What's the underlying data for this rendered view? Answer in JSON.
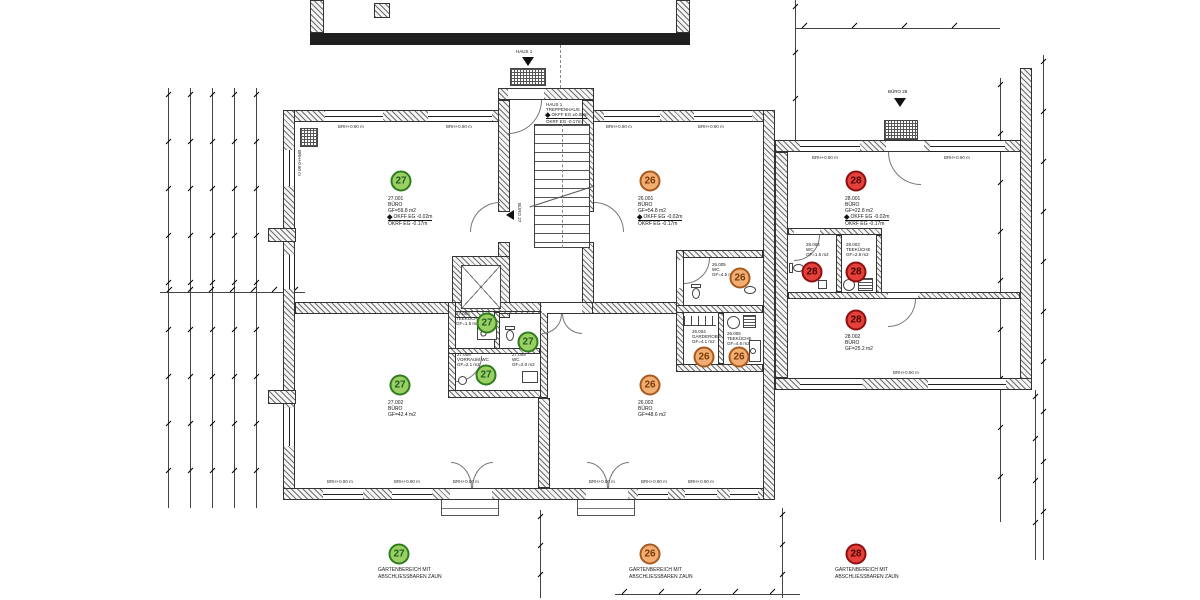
{
  "drawing": {
    "type": "Grundriss Erdgeschoss Bürogebäude"
  },
  "units": {
    "u27": {
      "number": "27",
      "fill": "#9ccf63",
      "ring": "#2e7d1c",
      "text_color": "#1b5e20"
    },
    "u26": {
      "number": "26",
      "fill": "#f2ad72",
      "ring": "#a85a1e",
      "text_color": "#7a3b08"
    },
    "u28": {
      "number": "28",
      "fill": "#e5413a",
      "ring": "#8c1010",
      "text_color": "#4a0000"
    }
  },
  "rooms": {
    "r27_001": {
      "id": "27.001",
      "name": "BÜRO",
      "area": "GF=59.8 m2",
      "okff": "OKFF EG -0.02m",
      "okrf": "OKRF EG -0.17m"
    },
    "r27_002": {
      "id": "27.002",
      "name": "BÜRO",
      "area": "GF=42.4 m2"
    },
    "r27_003": {
      "id": "27.003",
      "name": "TEEKÜCHE",
      "area": "GF=1.5 m2"
    },
    "r27_005": {
      "id": "27.005",
      "name": "WC",
      "area": "GF=2.0 m2"
    },
    "r27_006": {
      "id": "27.006",
      "name": "VORRAUM WC",
      "area": "GF=2.1 m2"
    },
    "r26_001": {
      "id": "26.001",
      "name": "BÜRO",
      "area": "GF=54.8 m2",
      "okff": "OKFF EG -0.02m",
      "okrf": "OKRF EG -0.17m"
    },
    "r26_002": {
      "id": "26.002",
      "name": "BÜRO",
      "area": "GF=48.6 m2"
    },
    "r26_004": {
      "id": "26.004",
      "name": "GARDEROBE",
      "area": "GF=4.1 m2"
    },
    "r26_005": {
      "id": "26.005",
      "name": "WC",
      "area": "GF=4.5 m2"
    },
    "r26_006": {
      "id": "26.006",
      "name": "TEEKÜCHE",
      "area": "GF=4.6 m2"
    },
    "r28_001": {
      "id": "28.001",
      "name": "BÜRO",
      "area": "GF=22.8 m2",
      "okff": "OKFF EG -0.02m",
      "okrf": "OKRF EG -0.17m"
    },
    "r28_002": {
      "id": "28.002",
      "name": "BÜRO",
      "area": "GF=25.2 m2"
    },
    "r28_003": {
      "id": "28.003",
      "name": "TEEKÜCHE",
      "area": "GF=2.8 m2"
    },
    "r28_004": {
      "id": "28.004",
      "name": "WC",
      "area": "GF=1.5 m2"
    }
  },
  "stairwell": {
    "house": "HAUS 1",
    "name": "TREPPENHAUS",
    "okff": "OKFF EG ±0.00m",
    "okrf": "OKRF EG -0.17m"
  },
  "entrances": {
    "haus1": "HAUS 1",
    "buero28": "BÜRO 28",
    "buero27": "BÜRO 27"
  },
  "wall_labels": {
    "brh090": "BRH+0.90 m",
    "brh000": "BRH+0.00 m"
  },
  "legend": {
    "items": [
      {
        "unit": "27",
        "line1": "GARTENBEREICH MIT",
        "line2": "ABSCHLIESSBAREN ZAUN"
      },
      {
        "unit": "26",
        "line1": "GARTENBEREICH MIT",
        "line2": "ABSCHLIESSBAREN ZAUN"
      },
      {
        "unit": "28",
        "line1": "GARTENBEREICH MIT",
        "line2": "ABSCHLIESSBAREN ZAUN"
      }
    ]
  }
}
